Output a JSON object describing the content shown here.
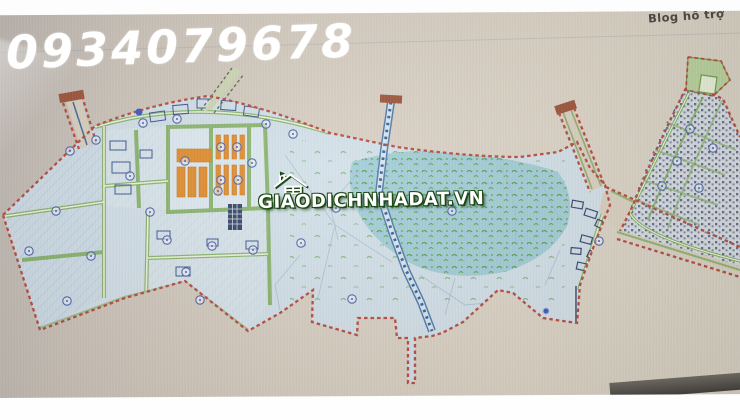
{
  "watermarks": {
    "phone": "0934079678",
    "site": "GIAODICHNHADAT.VN"
  },
  "header": {
    "blog_link": "Blog hỗ trợ"
  },
  "map": {
    "description": "Hand-drawn land-use planning map photographed from a screen",
    "colors": {
      "boundary_red": "#b5463a",
      "road_green": "#7aab55",
      "canal_blue": "#4a78a8",
      "industrial_orange": "#e08a28",
      "parcel_blue": "#d2e0e9",
      "vegetation_teal": "#9dcad7",
      "speckle_green": "#55a043",
      "lot_navy": "#33406a",
      "photo_background": "#d8cfc2"
    }
  }
}
